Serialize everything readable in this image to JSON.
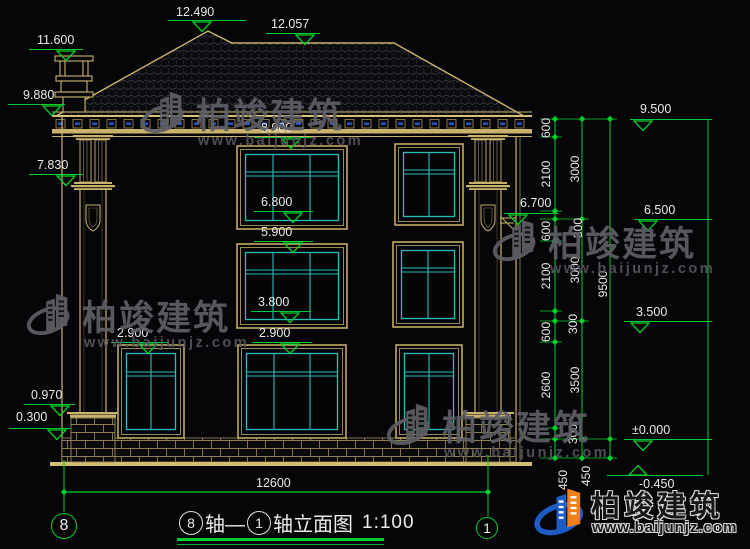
{
  "drawing": {
    "type": "building-elevation",
    "full_title": "⑧轴—①轴立面图 1:100"
  },
  "title": {
    "axis_from": "8",
    "segment1": "轴—",
    "axis_to": "1",
    "segment2": "轴立面图",
    "scale": "1:100"
  },
  "axis_bubbles": {
    "left": "8",
    "right": "1"
  },
  "bottom_dim": {
    "label": "12600"
  },
  "watermark": {
    "brand": "柏竣建筑",
    "url": "www.baijunjz.com",
    "gray_hex": "#5e5e66",
    "blue_hex": "#1d5cc4",
    "orange_hex": "#f08018"
  },
  "colors": {
    "line_green": "#00d02a",
    "draw_tan": "#c9b26b",
    "glass_cyan": "#2bbcb8",
    "text_white": "#eaeaea",
    "detail_blue": "#2a50d8"
  },
  "levels": [
    {
      "label": "12.490",
      "text_x": 176,
      "text_y": 5,
      "line_x1": 168,
      "line_x2": 246,
      "line_y": 20,
      "tri_x": 202,
      "dir": "down"
    },
    {
      "label": "12.057",
      "text_x": 271,
      "text_y": 17,
      "line_x1": 266,
      "line_x2": 320,
      "line_y": 33,
      "tri_x": 305,
      "dir": "down"
    },
    {
      "label": "11.600",
      "text_x": 37,
      "text_y": 33,
      "line_x1": 29,
      "line_x2": 83,
      "line_y": 49,
      "tri_x": 66,
      "dir": "down"
    },
    {
      "label": "9.880",
      "text_x": 23,
      "text_y": 88,
      "line_x1": 8,
      "line_x2": 65,
      "line_y": 104,
      "tri_x": 52,
      "dir": "down"
    },
    {
      "label": "7.830",
      "text_x": 37,
      "text_y": 158,
      "line_x1": 29,
      "line_x2": 83,
      "line_y": 174,
      "tri_x": 66,
      "dir": "down"
    },
    {
      "label": "8.900",
      "text_x": 261,
      "text_y": 121,
      "line_x1": 254,
      "line_x2": 313,
      "line_y": 137,
      "tri_x": 291,
      "dir": "down"
    },
    {
      "label": "6.800",
      "text_x": 261,
      "text_y": 195,
      "line_x1": 254,
      "line_x2": 313,
      "line_y": 211,
      "tri_x": 293,
      "dir": "down"
    },
    {
      "label": "5.900",
      "text_x": 261,
      "text_y": 225,
      "line_x1": 254,
      "line_x2": 313,
      "line_y": 241,
      "tri_x": 293,
      "dir": "down"
    },
    {
      "label": "3.800",
      "text_x": 258,
      "text_y": 295,
      "line_x1": 251,
      "line_x2": 311,
      "line_y": 311,
      "tri_x": 290,
      "dir": "down"
    },
    {
      "label": "2.900",
      "text_x": 117,
      "text_y": 326,
      "line_x1": 111,
      "line_x2": 169,
      "line_y": 342,
      "tri_x": 148,
      "dir": "down"
    },
    {
      "label": "2.900",
      "text_x": 259,
      "text_y": 326,
      "line_x1": 252,
      "line_x2": 312,
      "line_y": 342,
      "tri_x": 290,
      "dir": "down"
    },
    {
      "label": "0.970",
      "text_x": 31,
      "text_y": 388,
      "line_x1": 24,
      "line_x2": 75,
      "line_y": 404,
      "tri_x": 60,
      "dir": "down"
    },
    {
      "label": "0.300",
      "text_x": 16,
      "text_y": 410,
      "line_x1": 9,
      "line_x2": 71,
      "line_y": 428,
      "tri_x": 57,
      "dir": "down"
    },
    {
      "label": "9.500",
      "text_x": 640,
      "text_y": 102,
      "line_x1": 630,
      "line_x2": 712,
      "line_y": 119,
      "tri_x": 643,
      "dir": "down"
    },
    {
      "label": "6.700",
      "text_x": 520,
      "text_y": 196,
      "line_x1": 504,
      "line_x2": 558,
      "line_y": 213,
      "tri_x": 518,
      "dir": "down"
    },
    {
      "label": "6.500",
      "text_x": 644,
      "text_y": 203,
      "line_x1": 634,
      "line_x2": 712,
      "line_y": 219,
      "tri_x": 648,
      "dir": "down"
    },
    {
      "label": "3.500",
      "text_x": 636,
      "text_y": 305,
      "line_x1": 624,
      "line_x2": 712,
      "line_y": 321,
      "tri_x": 640,
      "dir": "down"
    },
    {
      "label": "±0.000",
      "text_x": 632,
      "text_y": 423,
      "line_x1": 624,
      "line_x2": 712,
      "line_y": 439,
      "tri_x": 643,
      "dir": "down"
    },
    {
      "label": "-0.450",
      "text_x": 639,
      "text_y": 477,
      "line_x1": 607,
      "line_x2": 703,
      "line_y": 475,
      "tri_x": 638,
      "dir": "up"
    }
  ],
  "vertical_dims": [
    {
      "label": "600",
      "x": 546,
      "y": 128
    },
    {
      "label": "2100",
      "x": 546,
      "y": 174
    },
    {
      "label": "300",
      "x": 578,
      "y": 228
    },
    {
      "label": "600",
      "x": 546,
      "y": 231
    },
    {
      "label": "2100",
      "x": 546,
      "y": 276
    },
    {
      "label": "300",
      "x": 573,
      "y": 324
    },
    {
      "label": "600",
      "x": 546,
      "y": 332
    },
    {
      "label": "2600",
      "x": 546,
      "y": 385
    },
    {
      "label": "300",
      "x": 573,
      "y": 434
    },
    {
      "label": "450",
      "x": 563,
      "y": 480
    },
    {
      "label": "3000",
      "x": 575,
      "y": 169
    },
    {
      "label": "3000",
      "x": 575,
      "y": 270
    },
    {
      "label": "3500",
      "x": 575,
      "y": 380
    },
    {
      "label": "450",
      "x": 586,
      "y": 476
    },
    {
      "label": "9500",
      "x": 603,
      "y": 284
    }
  ]
}
